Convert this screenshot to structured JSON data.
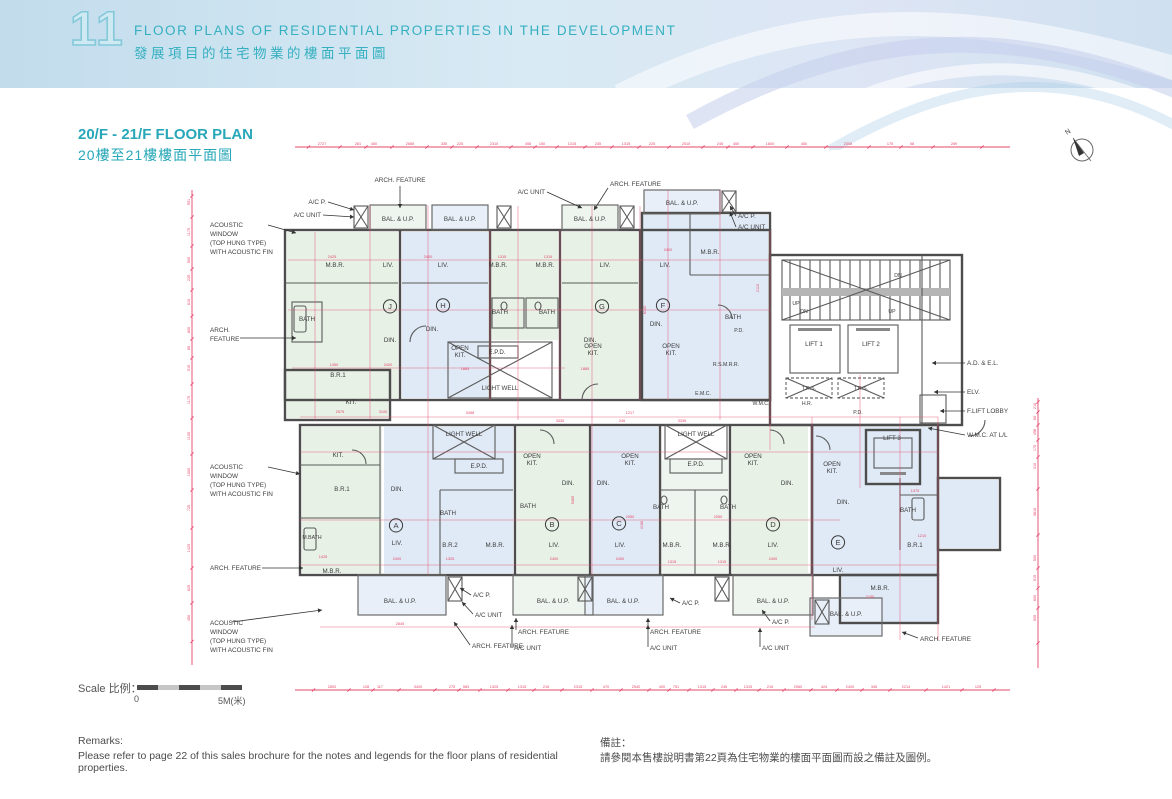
{
  "header": {
    "section_number": "11",
    "title_en": "FLOOR PLANS OF RESIDENTIAL PROPERTIES IN THE DEVELOPMENT",
    "title_zh": "發展項目的住宅物業的樓面平面圖"
  },
  "plan": {
    "title_en": "20/F - 21/F FLOOR PLAN",
    "title_zh": "20樓至21樓樓面平面圖",
    "north_label": "N"
  },
  "scalebar": {
    "label_en": "Scale",
    "label_zh": "比例：",
    "min": "0",
    "max": "5M(米)"
  },
  "remarks": {
    "title_en": "Remarks:",
    "body_en": "Please refer to page 22 of this sales brochure for the notes and legends for the floor plans of residential properties.",
    "title_zh": "備註：",
    "body_zh": "請參閱本售樓說明書第22頁為住宅物業的樓面平面圖而設之備註及圖例。"
  },
  "colors": {
    "accent_teal": "#27a7b8",
    "dim_red": "#e3486a",
    "wall_gray": "#4d4d4d",
    "room_green": "#e7f1e6",
    "room_blue": "#e0eaf6"
  },
  "units": [
    {
      "letter": "J",
      "x": 320,
      "y": 189
    },
    {
      "letter": "H",
      "x": 373,
      "y": 188
    },
    {
      "letter": "G",
      "x": 532,
      "y": 189
    },
    {
      "letter": "F",
      "x": 593,
      "y": 188
    },
    {
      "letter": "A",
      "x": 326,
      "y": 408
    },
    {
      "letter": "B",
      "x": 482,
      "y": 407
    },
    {
      "letter": "C",
      "x": 549,
      "y": 406
    },
    {
      "letter": "D",
      "x": 703,
      "y": 407
    },
    {
      "letter": "E",
      "x": 768,
      "y": 425
    }
  ],
  "rooms": [
    {
      "t": "M.B.R.",
      "x": 265,
      "y": 147
    },
    {
      "t": "LIV.",
      "x": 318,
      "y": 147
    },
    {
      "t": "BATH",
      "x": 237,
      "y": 201
    },
    {
      "t": "DIN.",
      "x": 320,
      "y": 222
    },
    {
      "t": "B.R.1",
      "x": 268,
      "y": 257
    },
    {
      "t": "KIT.",
      "x": 281,
      "y": 284
    },
    {
      "t": "LIV.",
      "x": 373,
      "y": 147
    },
    {
      "t": "DIN.",
      "x": 362,
      "y": 211
    },
    {
      "t": "OPEN\nKIT.",
      "x": 390,
      "y": 230
    },
    {
      "t": "M.B.R.",
      "x": 428,
      "y": 147
    },
    {
      "t": "M.B.R.",
      "x": 475,
      "y": 147
    },
    {
      "t": "BATH",
      "x": 430,
      "y": 194
    },
    {
      "t": "BATH",
      "x": 477,
      "y": 194
    },
    {
      "t": "E.P.D.",
      "x": 427,
      "y": 234
    },
    {
      "t": "LIGHT WELL",
      "x": 430,
      "y": 270
    },
    {
      "t": "LIV.",
      "x": 535,
      "y": 147
    },
    {
      "t": "DIN.",
      "x": 520,
      "y": 222
    },
    {
      "t": "OPEN\nKIT.",
      "x": 523,
      "y": 228
    },
    {
      "t": "LIV.",
      "x": 595,
      "y": 147
    },
    {
      "t": "DIN.",
      "x": 586,
      "y": 206
    },
    {
      "t": "M.B.R.",
      "x": 640,
      "y": 134
    },
    {
      "t": "BATH",
      "x": 663,
      "y": 199
    },
    {
      "t": "P.D.",
      "x": 669,
      "y": 212,
      "c": "rsm"
    },
    {
      "t": "OPEN\nKIT.",
      "x": 601,
      "y": 228
    },
    {
      "t": "R.S.M.R.R.",
      "x": 656,
      "y": 246,
      "c": "rsm"
    },
    {
      "t": "E.M.C.",
      "x": 633,
      "y": 275,
      "c": "rsm"
    },
    {
      "t": "W.M.C.",
      "x": 691,
      "y": 285,
      "c": "rsm"
    },
    {
      "t": "H.R.",
      "x": 737,
      "y": 285,
      "c": "rsm"
    },
    {
      "t": "UP",
      "x": 726,
      "y": 185,
      "c": "rsm"
    },
    {
      "t": "DN",
      "x": 734,
      "y": 193,
      "c": "rsm"
    },
    {
      "t": "DN",
      "x": 828,
      "y": 157,
      "c": "rsm"
    },
    {
      "t": "UP",
      "x": 822,
      "y": 193,
      "c": "rsm"
    },
    {
      "t": "LIFT 1",
      "x": 744,
      "y": 226
    },
    {
      "t": "LIFT 2",
      "x": 801,
      "y": 226
    },
    {
      "t": "T.R.S.",
      "x": 739,
      "y": 270,
      "c": "rsm"
    },
    {
      "t": "T.R.S.",
      "x": 791,
      "y": 270,
      "c": "rsm"
    },
    {
      "t": "P.D.",
      "x": 788,
      "y": 294,
      "c": "rsm"
    },
    {
      "t": "LIFT 3",
      "x": 822,
      "y": 320
    },
    {
      "t": "BAL. & U.P.",
      "x": 328,
      "y": 101
    },
    {
      "t": "BAL. & U.P.",
      "x": 390,
      "y": 101
    },
    {
      "t": "BAL. & U.P.",
      "x": 520,
      "y": 101
    },
    {
      "t": "BAL. & U.P.",
      "x": 612,
      "y": 85
    },
    {
      "t": "KIT.",
      "x": 268,
      "y": 337
    },
    {
      "t": "B.R.1",
      "x": 272,
      "y": 371
    },
    {
      "t": "DIN.",
      "x": 327,
      "y": 371
    },
    {
      "t": "M.BATH",
      "x": 242,
      "y": 419,
      "c": "rsm"
    },
    {
      "t": "M.B.R.",
      "x": 262,
      "y": 453
    },
    {
      "t": "LIV.",
      "x": 327,
      "y": 425
    },
    {
      "t": "BATH",
      "x": 378,
      "y": 395
    },
    {
      "t": "B.R.2",
      "x": 380,
      "y": 427
    },
    {
      "t": "BAL. & U.P.",
      "x": 330,
      "y": 483
    },
    {
      "t": "LIGHT WELL",
      "x": 394,
      "y": 316
    },
    {
      "t": "E.P.D.",
      "x": 409,
      "y": 348
    },
    {
      "t": "M.B.R.",
      "x": 425,
      "y": 427
    },
    {
      "t": "OPEN\nKIT.",
      "x": 462,
      "y": 338
    },
    {
      "t": "DIN.",
      "x": 498,
      "y": 365
    },
    {
      "t": "BATH",
      "x": 458,
      "y": 388
    },
    {
      "t": "LIV.",
      "x": 484,
      "y": 427
    },
    {
      "t": "BAL. & U.P.",
      "x": 483,
      "y": 483
    },
    {
      "t": "OPEN\nKIT.",
      "x": 560,
      "y": 338
    },
    {
      "t": "DIN.",
      "x": 533,
      "y": 365
    },
    {
      "t": "LIV.",
      "x": 550,
      "y": 427
    },
    {
      "t": "BAL. & U.P.",
      "x": 553,
      "y": 483
    },
    {
      "t": "LIGHT WELL",
      "x": 626,
      "y": 316
    },
    {
      "t": "E.P.D.",
      "x": 626,
      "y": 346
    },
    {
      "t": "BATH",
      "x": 591,
      "y": 389
    },
    {
      "t": "BATH",
      "x": 658,
      "y": 389
    },
    {
      "t": "M.B.R.",
      "x": 602,
      "y": 427
    },
    {
      "t": "M.B.R.",
      "x": 652,
      "y": 427
    },
    {
      "t": "OPEN\nKIT.",
      "x": 683,
      "y": 338
    },
    {
      "t": "DIN.",
      "x": 717,
      "y": 365
    },
    {
      "t": "LIV.",
      "x": 703,
      "y": 427
    },
    {
      "t": "BAL. & U.P.",
      "x": 703,
      "y": 483
    },
    {
      "t": "OPEN\nKIT.",
      "x": 762,
      "y": 346
    },
    {
      "t": "DIN.",
      "x": 773,
      "y": 384
    },
    {
      "t": "LIV.",
      "x": 768,
      "y": 452
    },
    {
      "t": "BATH",
      "x": 838,
      "y": 392
    },
    {
      "t": "B.R.1",
      "x": 845,
      "y": 427
    },
    {
      "t": "M.B.R.",
      "x": 810,
      "y": 470
    },
    {
      "t": "BAL. & U.P.",
      "x": 776,
      "y": 496
    }
  ],
  "callouts": [
    {
      "t": "ARCH. FEATURE",
      "x": 330,
      "y": 62,
      "a": "middle",
      "l": [
        330,
        66,
        330,
        88
      ]
    },
    {
      "t": "A/C P.",
      "x": 256,
      "y": 84,
      "a": "end",
      "l": [
        258,
        82,
        284,
        90
      ]
    },
    {
      "t": "A/C UNIT",
      "x": 251,
      "y": 97,
      "a": "end",
      "l": [
        253,
        95,
        284,
        97
      ]
    },
    {
      "t": "A/C UNIT",
      "x": 475,
      "y": 74,
      "a": "end",
      "l": [
        477,
        72,
        512,
        88
      ]
    },
    {
      "t": "ARCH. FEATURE",
      "x": 540,
      "y": 66,
      "a": "start",
      "l": [
        538,
        68,
        524,
        90
      ]
    },
    {
      "t": "A/C P.",
      "x": 668,
      "y": 98,
      "a": "start",
      "l": [
        666,
        96,
        660,
        86
      ]
    },
    {
      "t": "A/C UNIT",
      "x": 668,
      "y": 109,
      "a": "start",
      "l": [
        666,
        107,
        660,
        92
      ]
    },
    {
      "t": "A.D. & E.L.",
      "x": 897,
      "y": 245,
      "a": "start",
      "l": [
        895,
        243,
        862,
        243
      ]
    },
    {
      "t": "ELV.",
      "x": 897,
      "y": 274,
      "a": "start",
      "l": [
        895,
        272,
        864,
        272
      ]
    },
    {
      "t": "F.LIFT LOBBY",
      "x": 897,
      "y": 293,
      "a": "start",
      "l": [
        895,
        291,
        870,
        291
      ]
    },
    {
      "t": "W.M.C. AT L/L",
      "x": 897,
      "y": 317,
      "a": "start",
      "l": [
        895,
        315,
        858,
        308
      ]
    },
    {
      "t": "ACOUSTIC\nWINDOW\n(TOP HUNG TYPE)\nWITH ACOUSTIC FIN",
      "x": 140,
      "y": 107,
      "a": "start",
      "l": [
        198,
        105,
        226,
        113
      ]
    },
    {
      "t": "ARCH.\nFEATURE",
      "x": 140,
      "y": 212,
      "a": "start",
      "l": [
        170,
        218,
        226,
        218
      ]
    },
    {
      "t": "ACOUSTIC\nWINDOW\n(TOP HUNG TYPE)\nWITH ACOUSTIC FIN",
      "x": 140,
      "y": 349,
      "a": "start",
      "l": [
        198,
        347,
        230,
        354
      ]
    },
    {
      "t": "ARCH. FEATURE",
      "x": 140,
      "y": 450,
      "a": "start",
      "l": [
        192,
        448,
        233,
        448
      ]
    },
    {
      "t": "ACOUSTIC\nWINDOW\n(TOP HUNG TYPE)\nWITH ACOUSTIC FIN",
      "x": 140,
      "y": 505,
      "a": "start",
      "l": [
        162,
        502,
        252,
        490
      ]
    },
    {
      "t": "A/C P.",
      "x": 403,
      "y": 477,
      "a": "start",
      "l": [
        401,
        475,
        390,
        468
      ]
    },
    {
      "t": "A/C UNIT",
      "x": 405,
      "y": 497,
      "a": "start",
      "l": [
        403,
        494,
        392,
        482
      ]
    },
    {
      "t": "ARCH. FEATURE",
      "x": 402,
      "y": 528,
      "a": "start",
      "l": [
        400,
        525,
        384,
        502
      ]
    },
    {
      "t": "ARCH. FEATURE",
      "x": 448,
      "y": 514,
      "a": "start",
      "l": [
        446,
        510,
        446,
        498
      ]
    },
    {
      "t": "A/C UNIT",
      "x": 444,
      "y": 530,
      "a": "start",
      "l": [
        442,
        527,
        442,
        505
      ]
    },
    {
      "t": "A/C P.",
      "x": 612,
      "y": 485,
      "a": "start",
      "l": [
        610,
        483,
        600,
        478
      ]
    },
    {
      "t": "ARCH. FEATURE",
      "x": 580,
      "y": 514,
      "a": "start",
      "l": [
        578,
        510,
        578,
        498
      ]
    },
    {
      "t": "A/C UNIT",
      "x": 580,
      "y": 530,
      "a": "start",
      "l": [
        578,
        527,
        578,
        505
      ]
    },
    {
      "t": "A/C P.",
      "x": 702,
      "y": 504,
      "a": "start",
      "l": [
        700,
        501,
        692,
        490
      ]
    },
    {
      "t": "A/C UNIT",
      "x": 692,
      "y": 530,
      "a": "start",
      "l": [
        690,
        527,
        690,
        508
      ]
    },
    {
      "t": "ARCH. FEATURE",
      "x": 850,
      "y": 521,
      "a": "start",
      "l": [
        848,
        518,
        832,
        512
      ]
    }
  ],
  "dims": {
    "top": {
      "y": 27,
      "x1": 225,
      "x2": 940,
      "labels": [
        {
          "t": "2727",
          "x": 252
        },
        {
          "t": "281",
          "x": 288
        },
        {
          "t": "450",
          "x": 304
        },
        {
          "t": "2685",
          "x": 340
        },
        {
          "t": "335",
          "x": 374
        },
        {
          "t": "225",
          "x": 390
        },
        {
          "t": "2315",
          "x": 424
        },
        {
          "t": "455",
          "x": 458
        },
        {
          "t": "150",
          "x": 472
        },
        {
          "t": "1315",
          "x": 502
        },
        {
          "t": "245",
          "x": 528
        },
        {
          "t": "1315",
          "x": 556
        },
        {
          "t": "225",
          "x": 582
        },
        {
          "t": "2515",
          "x": 616
        },
        {
          "t": "245",
          "x": 650
        },
        {
          "t": "450",
          "x": 666
        },
        {
          "t": "1800",
          "x": 700
        },
        {
          "t": "450",
          "x": 734
        },
        {
          "t": "2308",
          "x": 778
        },
        {
          "t": "175",
          "x": 820
        },
        {
          "t": "58",
          "x": 842
        },
        {
          "t": "269",
          "x": 884
        }
      ]
    },
    "bottom": {
      "y": 570,
      "x1": 225,
      "x2": 940,
      "labels": [
        {
          "t": "2800",
          "x": 262
        },
        {
          "t": "128",
          "x": 296
        },
        {
          "t": "117",
          "x": 310
        },
        {
          "t": "3400",
          "x": 348
        },
        {
          "t": "275",
          "x": 382
        },
        {
          "t": "583",
          "x": 396
        },
        {
          "t": "1325",
          "x": 424
        },
        {
          "t": "1315",
          "x": 452
        },
        {
          "t": "215",
          "x": 476
        },
        {
          "t": "2315",
          "x": 508
        },
        {
          "t": "470",
          "x": 536
        },
        {
          "t": "2540",
          "x": 566
        },
        {
          "t": "400",
          "x": 592
        },
        {
          "t": "751",
          "x": 606
        },
        {
          "t": "1315",
          "x": 632
        },
        {
          "t": "245",
          "x": 654
        },
        {
          "t": "1315",
          "x": 678
        },
        {
          "t": "215",
          "x": 700
        },
        {
          "t": "2060",
          "x": 728
        },
        {
          "t": "424",
          "x": 754
        },
        {
          "t": "2400",
          "x": 780
        },
        {
          "t": "345",
          "x": 804
        },
        {
          "t": "2214",
          "x": 836
        },
        {
          "t": "1421",
          "x": 876
        },
        {
          "t": "125",
          "x": 908
        }
      ]
    },
    "left": {
      "x": 122,
      "y1": 70,
      "y2": 545,
      "labels": [
        {
          "t": "591",
          "y": 82
        },
        {
          "t": "1175",
          "y": 112
        },
        {
          "t": "500",
          "y": 140
        },
        {
          "t": "225",
          "y": 158
        },
        {
          "t": "610",
          "y": 182
        },
        {
          "t": "800",
          "y": 210
        },
        {
          "t": "85",
          "y": 228
        },
        {
          "t": "515",
          "y": 248
        },
        {
          "t": "1175",
          "y": 280
        },
        {
          "t": "1105",
          "y": 316
        },
        {
          "t": "1000",
          "y": 352
        },
        {
          "t": "725",
          "y": 388
        },
        {
          "t": "1425",
          "y": 428
        },
        {
          "t": "625",
          "y": 468
        },
        {
          "t": "450",
          "y": 498
        }
      ]
    },
    "right": {
      "x": 968,
      "y1": 278,
      "y2": 548,
      "labels": [
        {
          "t": "210",
          "y": 286
        },
        {
          "t": "65",
          "y": 298
        },
        {
          "t": "498",
          "y": 312
        },
        {
          "t": "175",
          "y": 328
        },
        {
          "t": "310",
          "y": 346
        },
        {
          "t": "3816",
          "y": 392
        },
        {
          "t": "500",
          "y": 438
        },
        {
          "t": "515",
          "y": 458
        },
        {
          "t": "600",
          "y": 478
        },
        {
          "t": "505",
          "y": 498
        }
      ]
    },
    "inner": [
      {
        "t": "2425",
        "x": 262,
        "y": 138
      },
      {
        "t": "2400",
        "x": 358,
        "y": 138
      },
      {
        "t": "1315",
        "x": 432,
        "y": 138
      },
      {
        "t": "1315",
        "x": 478,
        "y": 138
      },
      {
        "t": "2400",
        "x": 598,
        "y": 131
      },
      {
        "t": "2400",
        "x": 318,
        "y": 246
      },
      {
        "t": "1450",
        "x": 264,
        "y": 246
      },
      {
        "t": "1885",
        "x": 395,
        "y": 250
      },
      {
        "t": "1885",
        "x": 515,
        "y": 250
      },
      {
        "t": "3458",
        "x": 400,
        "y": 294
      },
      {
        "t": "1217",
        "x": 560,
        "y": 294
      },
      {
        "t": "3335",
        "x": 490,
        "y": 302
      },
      {
        "t": "245",
        "x": 552,
        "y": 302
      },
      {
        "t": "3335",
        "x": 612,
        "y": 302
      },
      {
        "t": "2050",
        "x": 560,
        "y": 398
      },
      {
        "t": "2050",
        "x": 648,
        "y": 398
      },
      {
        "t": "2400",
        "x": 327,
        "y": 440
      },
      {
        "t": "2400",
        "x": 484,
        "y": 440
      },
      {
        "t": "2400",
        "x": 550,
        "y": 440
      },
      {
        "t": "2400",
        "x": 703,
        "y": 440
      },
      {
        "t": "1325",
        "x": 380,
        "y": 440
      },
      {
        "t": "1315",
        "x": 602,
        "y": 443
      },
      {
        "t": "1315",
        "x": 652,
        "y": 443
      },
      {
        "t": "8140",
        "x": 576,
        "y": 190,
        "r": 1
      },
      {
        "t": "5365",
        "x": 504,
        "y": 380,
        "r": 1
      },
      {
        "t": "4156",
        "x": 573,
        "y": 405,
        "r": 1
      },
      {
        "t": "2110",
        "x": 689,
        "y": 168,
        "r": 1
      },
      {
        "t": "2845",
        "x": 330,
        "y": 505
      },
      {
        "t": "1425",
        "x": 253,
        "y": 438
      },
      {
        "t": "2575",
        "x": 270,
        "y": 293
      },
      {
        "t": "3100",
        "x": 313,
        "y": 293
      },
      {
        "t": "1210",
        "x": 852,
        "y": 417
      },
      {
        "t": "2150",
        "x": 800,
        "y": 478
      },
      {
        "t": "1375",
        "x": 845,
        "y": 372
      }
    ]
  }
}
